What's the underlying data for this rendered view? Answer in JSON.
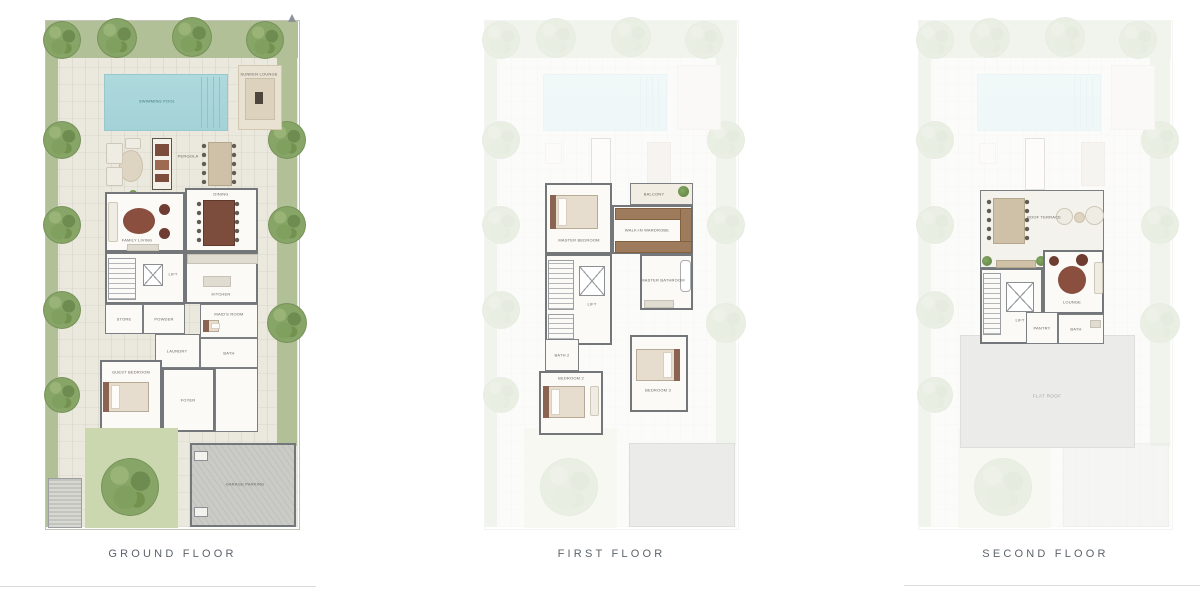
{
  "floors": [
    {
      "label": "GROUND FLOOR",
      "rooms": {
        "pool": "SWIMMING POOL",
        "pavilion": "SUNKEN LOUNGE",
        "pergola": "PERGOLA",
        "living": "FAMILY LIVING",
        "dining": "DINING",
        "kitchen": "KITCHEN",
        "store": "STORE",
        "powder": "POWDER",
        "maid": "MAID'S ROOM",
        "laundry": "LAUNDRY",
        "bath": "BATH",
        "lift": "LIFT",
        "guest": "GUEST BEDROOM",
        "foyer": "FOYER",
        "garage": "GARAGE PARKING"
      }
    },
    {
      "label": "FIRST FLOOR",
      "rooms": {
        "master": "MASTER BEDROOM",
        "balcony": "BALCONY",
        "wardrobe": "WALK-IN WARDROBE",
        "masterbath": "MASTER BATHROOM",
        "lift": "LIFT",
        "bath2": "BATH 2",
        "bed2": "BEDROOM 2",
        "bed3": "BEDROOM 3"
      }
    },
    {
      "label": "SECOND FLOOR",
      "rooms": {
        "terrace": "ROOF TERRACE",
        "lounge": "LOUNGE",
        "lift": "LIFT",
        "pantry": "PANTRY",
        "bath": "BATH",
        "roof": "FLAT ROOF"
      }
    }
  ],
  "palette": {
    "garden_green": "#b2c098",
    "lawn_green": "#cbd7ae",
    "pool_blue": "#a8d6da",
    "paving": "#ebe8de",
    "wall_grey": "#73777a",
    "furniture_wood": "#7c4d3d",
    "caption_grey": "#5d636b"
  }
}
